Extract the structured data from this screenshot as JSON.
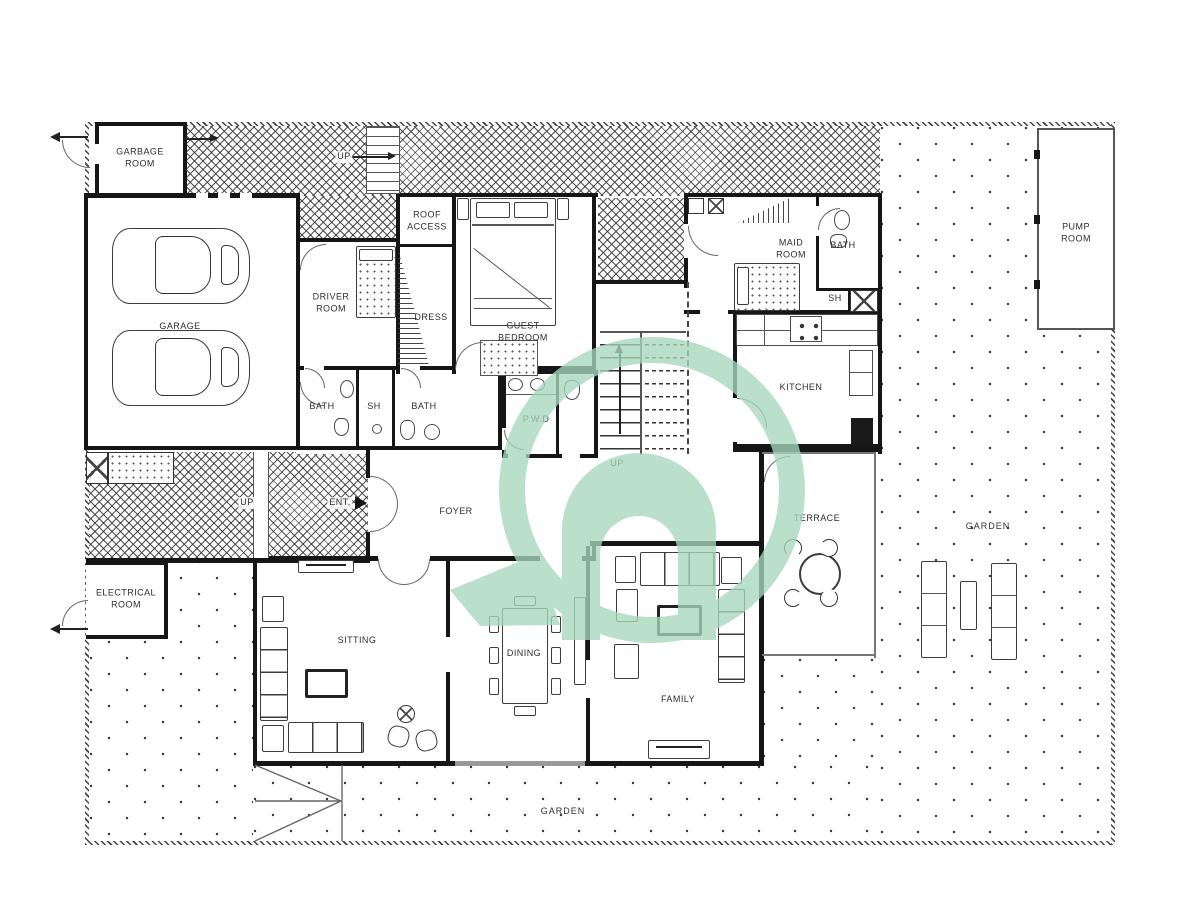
{
  "colors": {
    "watermark_green": "#a7d7bd",
    "wall_black": "#161616",
    "line_gray": "#555555"
  },
  "labels": {
    "garbage_room": "GARBAGE\nROOM",
    "garage": "GARAGE",
    "up_entry_stair": "UP",
    "roof_access": "ROOF\nACCESS",
    "driver_room": "DRIVER\nROOM",
    "dress": "DRESS",
    "guest_bedroom": "GUEST\nBEDROOM",
    "maid_room": "MAID\nROOM",
    "maid_bath": "BATH",
    "maid_shower": "SH",
    "kitchen": "KITCHEN",
    "pump_room": "PUMP\nROOM",
    "bath_1": "BATH",
    "shower_1": "SH",
    "bath_2": "BATH",
    "powder_room": "P.W.D",
    "stairs_up": "UP",
    "ramp_up": "UP",
    "entrance": "ENT.",
    "foyer": "FOYER",
    "electrical_room": "ELECTRICAL\nROOM",
    "sitting": "SITTING",
    "dining": "DINING",
    "family": "FAMILY",
    "terrace": "TERRACE",
    "garden_right": "GARDEN",
    "garden_bottom": "GARDEN"
  }
}
